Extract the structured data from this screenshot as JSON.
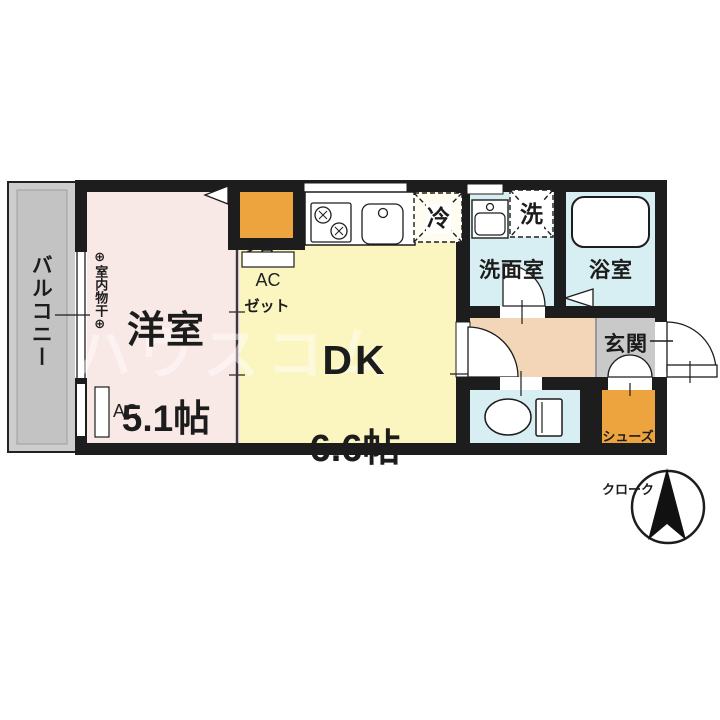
{
  "plan": {
    "balcony_label": "バルコニー",
    "drying_label": "⊕室内物干⊕",
    "western_room": {
      "name": "洋室",
      "area": "5.1帖"
    },
    "dk": {
      "name": "DK",
      "area": "6.6帖"
    },
    "closet_line1": "クロー",
    "closet_line2": "ゼット",
    "ac_upper": "AC",
    "ac_lower": "AC",
    "fridge": "冷",
    "washer": "洗",
    "washroom": "洗面室",
    "bathroom": "浴室",
    "entrance": "玄関",
    "shoe_cloak_line1": "シューズ",
    "shoe_cloak_line2": "クローク",
    "watermark": "ハウスコム",
    "colors": {
      "wall": "#1d1d1d",
      "western_room_fill": "#f8e8e6",
      "dk_fill": "#fbf5c0",
      "wet_room_fill": "#d7eef2",
      "hall_fill": "#f3d6b8",
      "entrance_fill": "#c9c9c9",
      "storage_fill": "#eea43e",
      "balcony_fill": "#cdcdcd"
    }
  }
}
